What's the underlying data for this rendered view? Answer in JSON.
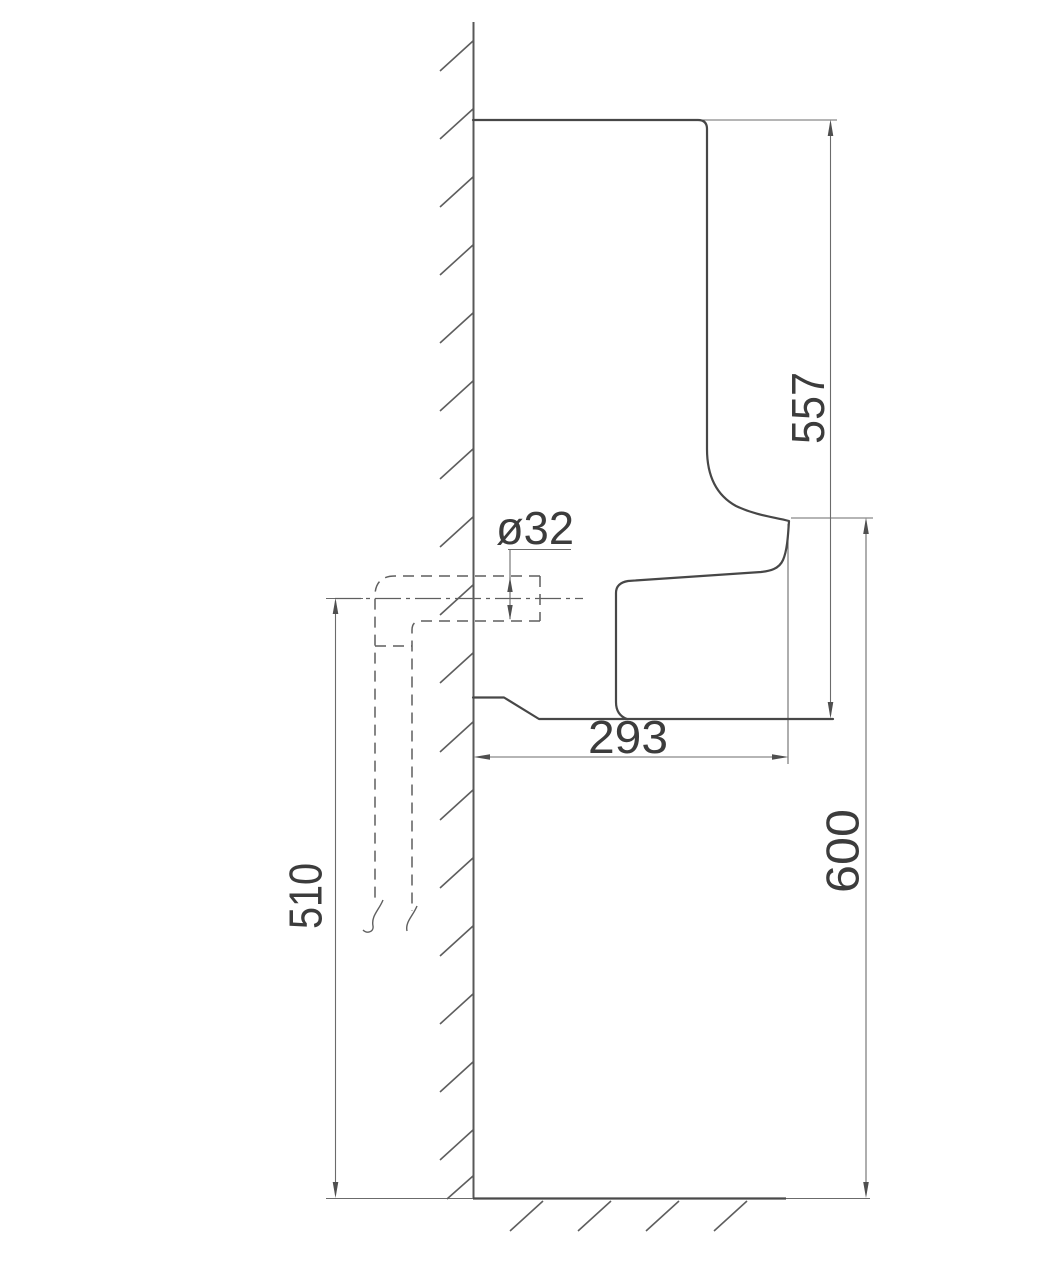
{
  "colors": {
    "background": "#ffffff",
    "wall_line": "#585858",
    "fixture_outline": "#474747",
    "hidden_line": "#5f5f5f",
    "dimension_line": "#6b6b6b",
    "text": "#3c3c3c"
  },
  "dimensions": {
    "overall_height": "557",
    "rim_height_to_floor": "600",
    "outlet_center_to_floor": "510",
    "depth_from_wall": "293",
    "outlet_diameter": "ø32"
  }
}
